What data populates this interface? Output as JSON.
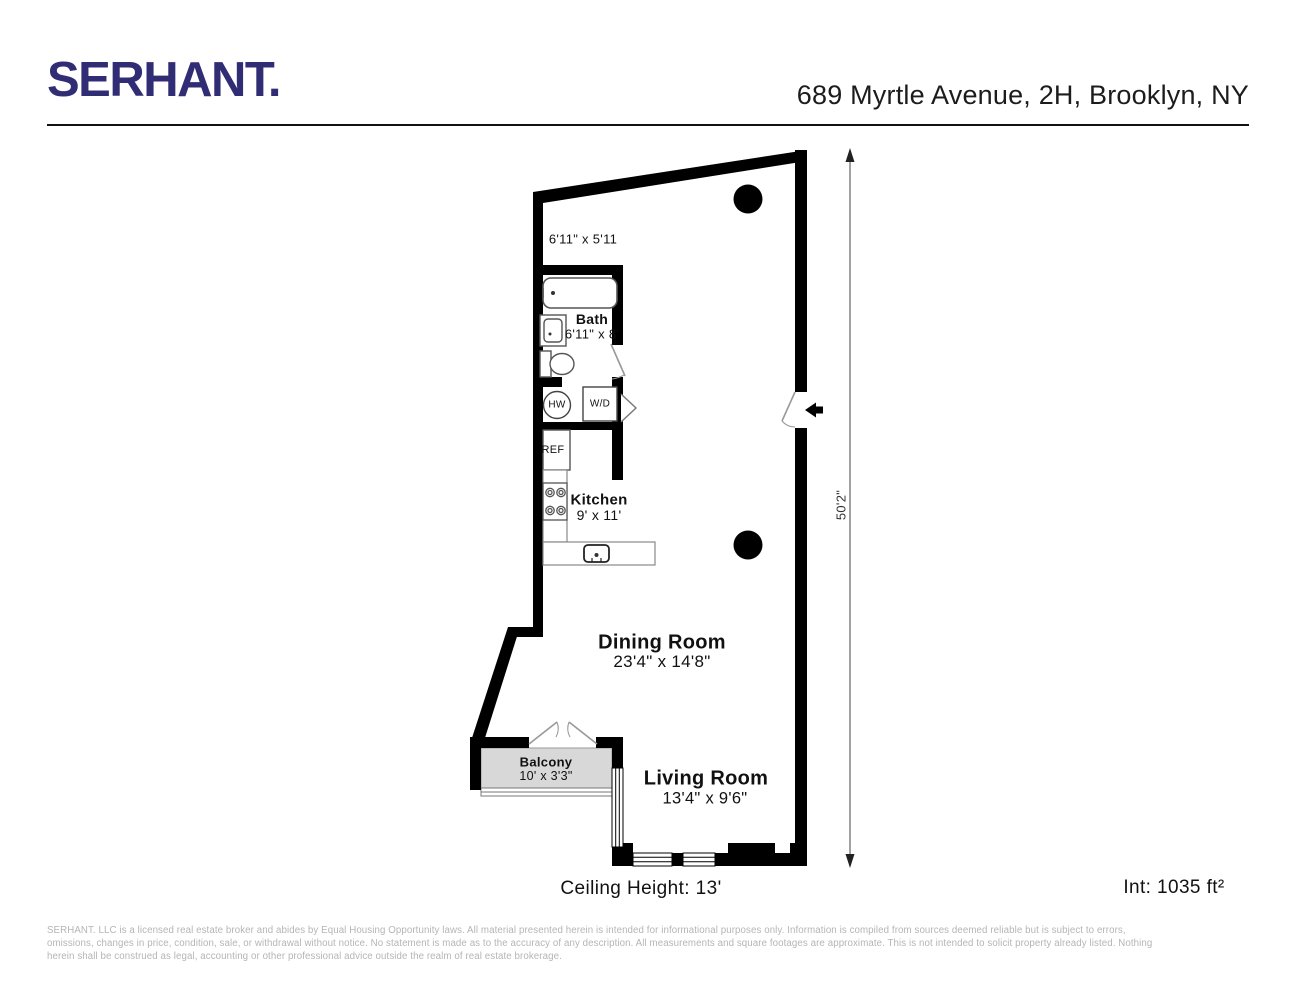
{
  "header": {
    "brand": "SERHANT.",
    "address": "689 Myrtle Avenue, 2H, Brooklyn, NY"
  },
  "floorplan": {
    "entry_dim": "6'11\" x 5'11",
    "rooms": {
      "bath": {
        "name": "Bath",
        "dims": "6'11\" x 8'"
      },
      "kitchen": {
        "name": "Kitchen",
        "dims": "9' x 11'"
      },
      "dining": {
        "name": "Dining Room",
        "dims": "23'4\" x 14'8\""
      },
      "living": {
        "name": "Living Room",
        "dims": "13'4\" x 9'6\""
      },
      "balcony": {
        "name": "Balcony",
        "dims": "10' x 3'3\""
      }
    },
    "fixtures": {
      "hw": "HW",
      "wd": "W/D",
      "ref": "REF"
    },
    "dimension_line": "50'2\"",
    "ceiling_height": "Ceiling Height: 13'",
    "interior_area": "Int: 1035 ft²"
  },
  "footer": {
    "line1": "SERHANT. LLC is a licensed real estate broker and abides by Equal Housing Opportunity laws. All material presented herein is intended for informational purposes only. Information is compiled from sources deemed reliable but is subject to errors,",
    "line2": "omissions, changes in price, condition, sale, or withdrawal without notice. No statement is made as to the accuracy of any description. All measurements and square footages are approximate. This is not intended to solicit property already listed. Nothing",
    "line3": "herein shall be construed as legal, accounting or other professional advice outside the realm of real estate brokerage."
  }
}
